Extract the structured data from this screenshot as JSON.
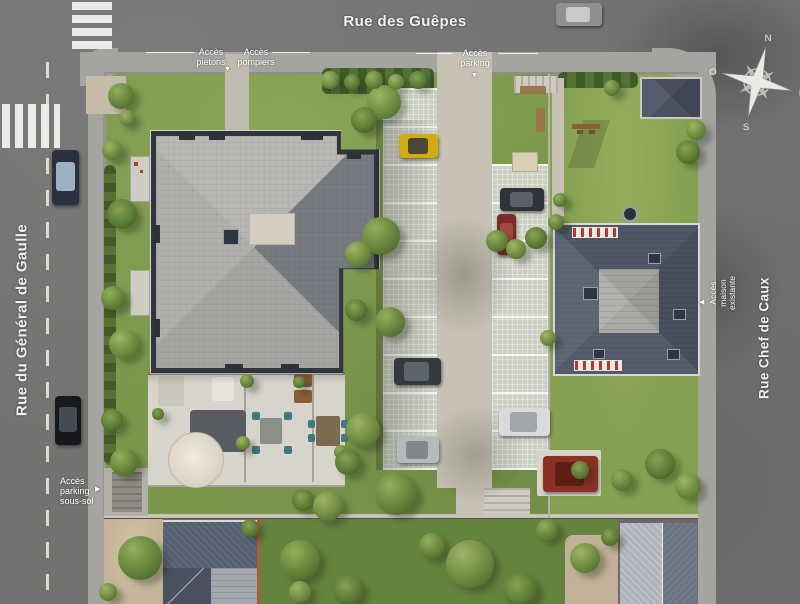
{
  "streets": {
    "top": "Rue des Guêpes",
    "left": "Rue du Général de Gaulle",
    "right": "Rue Chef de Caux"
  },
  "labels": {
    "pedestrian": {
      "line1": "Accès",
      "line2": "piétons"
    },
    "fire": {
      "line1": "Accès",
      "line2": "pompiers"
    },
    "parking": {
      "line1": "Accès",
      "line2": "parking"
    },
    "basement_parking": {
      "line1": "Accès",
      "line2": "parking",
      "line3": "sous-sol"
    },
    "existing_house": {
      "line1": "Accès",
      "line2": "maison",
      "line3": "existante"
    }
  },
  "compass": {
    "north": "N",
    "east": "E",
    "south": "S",
    "west": "O"
  },
  "colors": {
    "road": "#717170",
    "sidewalk": "#a5a4a1",
    "lawn": "#7a974c",
    "roof_new_building": "#a6a5a2",
    "roof_existing_house": "#4d5565",
    "driveway": "#c7c2b3",
    "label_text": "#ffffff"
  },
  "cars": [
    {
      "name": "car-rue-des-guepes",
      "x": 556,
      "y": 3,
      "w": 46,
      "h": 23,
      "body": "#8e9092",
      "glass": "#c8cacc",
      "vertical": false
    },
    {
      "name": "car-general-de-gaulle-1",
      "x": 52,
      "y": 150,
      "w": 27,
      "h": 55,
      "body": "#2b3140",
      "glass": "#9fb2c2",
      "vertical": true
    },
    {
      "name": "car-general-de-gaulle-2",
      "x": 55,
      "y": 396,
      "w": 26,
      "h": 49,
      "body": "#17191d",
      "glass": "#464c54",
      "vertical": true
    },
    {
      "name": "car-parking-yellow",
      "x": 399,
      "y": 134,
      "w": 39,
      "h": 24,
      "body": "#d2ab10",
      "glass": "#4a4738",
      "vertical": false
    },
    {
      "name": "car-parking-dark-1",
      "x": 500,
      "y": 188,
      "w": 44,
      "h": 23,
      "body": "#2e3338",
      "glass": "#5b6168",
      "vertical": false
    },
    {
      "name": "car-parking-darkred",
      "x": 497,
      "y": 214,
      "w": 19,
      "h": 41,
      "body": "#7b2b26",
      "glass": "#a14a42",
      "vertical": true
    },
    {
      "name": "car-parking-dark-2",
      "x": 394,
      "y": 358,
      "w": 47,
      "h": 27,
      "body": "#34383f",
      "glass": "#5d646d",
      "vertical": false
    },
    {
      "name": "car-parking-silver",
      "x": 397,
      "y": 437,
      "w": 42,
      "h": 26,
      "body": "#b7babc",
      "glass": "#83878b",
      "vertical": false
    },
    {
      "name": "car-parking-white",
      "x": 499,
      "y": 408,
      "w": 51,
      "h": 28,
      "body": "#d8dadb",
      "glass": "#a2a6a9",
      "vertical": false
    },
    {
      "name": "car-parking-red",
      "x": 543,
      "y": 456,
      "w": 55,
      "h": 36,
      "body": "#8e2f24",
      "glass": "#5e1d15",
      "vertical": false
    }
  ],
  "trees": [
    [
      121,
      96,
      13
    ],
    [
      112,
      150,
      10
    ],
    [
      122,
      214,
      15
    ],
    [
      113,
      298,
      12
    ],
    [
      124,
      344,
      15
    ],
    [
      112,
      420,
      11
    ],
    [
      124,
      462,
      14
    ],
    [
      127,
      118,
      8
    ],
    [
      158,
      414,
      6
    ],
    [
      247,
      381,
      7
    ],
    [
      243,
      443,
      7
    ],
    [
      299,
      382,
      6
    ],
    [
      341,
      452,
      7
    ],
    [
      384,
      102,
      17
    ],
    [
      364,
      120,
      13
    ],
    [
      381,
      236,
      19
    ],
    [
      358,
      254,
      13
    ],
    [
      356,
      310,
      11
    ],
    [
      390,
      322,
      15
    ],
    [
      363,
      430,
      17
    ],
    [
      348,
      462,
      13
    ],
    [
      396,
      494,
      21
    ],
    [
      328,
      506,
      15
    ],
    [
      303,
      500,
      11
    ],
    [
      497,
      241,
      11
    ],
    [
      516,
      249,
      10
    ],
    [
      536,
      238,
      11
    ],
    [
      556,
      222,
      8
    ],
    [
      330,
      80,
      9
    ],
    [
      352,
      82,
      8
    ],
    [
      374,
      80,
      9
    ],
    [
      396,
      82,
      8
    ],
    [
      418,
      80,
      9
    ],
    [
      612,
      88,
      8
    ],
    [
      696,
      130,
      10
    ],
    [
      688,
      152,
      12
    ],
    [
      560,
      200,
      7
    ],
    [
      548,
      338,
      8
    ],
    [
      660,
      464,
      15
    ],
    [
      622,
      480,
      11
    ],
    [
      688,
      486,
      13
    ],
    [
      580,
      470,
      9
    ],
    [
      140,
      558,
      22
    ],
    [
      108,
      592,
      9
    ],
    [
      250,
      528,
      9
    ],
    [
      300,
      560,
      20
    ],
    [
      300,
      592,
      11
    ],
    [
      348,
      590,
      15
    ],
    [
      432,
      546,
      13
    ],
    [
      470,
      564,
      24
    ],
    [
      520,
      590,
      17
    ],
    [
      547,
      530,
      11
    ],
    [
      585,
      558,
      15
    ],
    [
      610,
      537,
      9
    ]
  ]
}
